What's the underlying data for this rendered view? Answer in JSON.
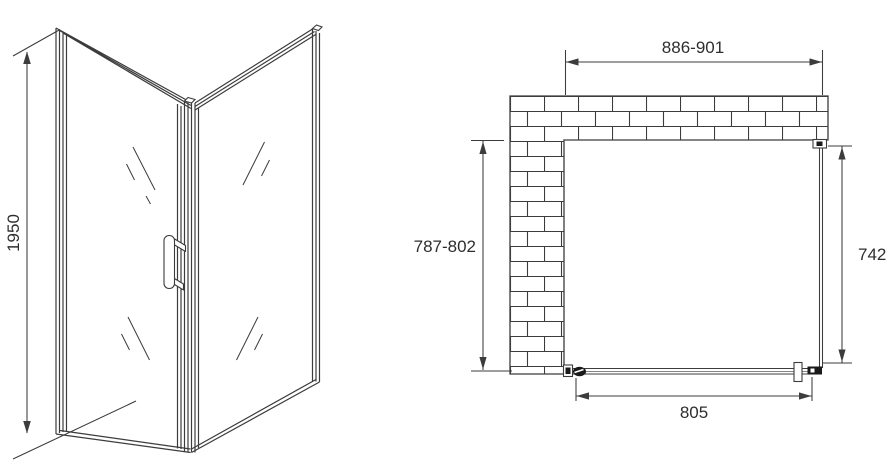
{
  "colors": {
    "background": "#ffffff",
    "line": "#3c3c3c",
    "text": "#2e2e2e",
    "dark_fill": "#1a1a1a"
  },
  "perspective_view": {
    "height_dimension": "1950"
  },
  "plan_view": {
    "top_width_dimension": "886-901",
    "left_depth_dimension": "787-802",
    "right_panel_dimension": "742",
    "door_width_dimension": "805"
  }
}
